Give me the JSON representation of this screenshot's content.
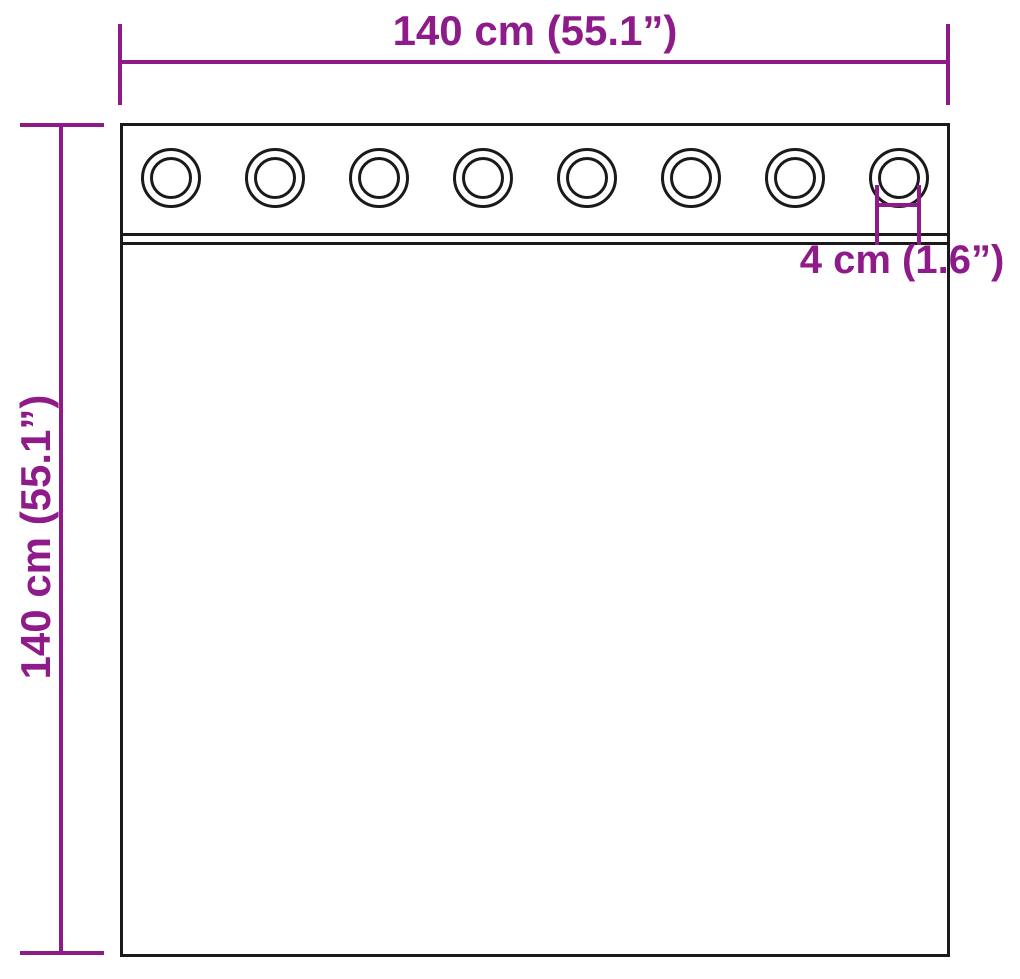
{
  "diagram": {
    "description": "Curtain with grommets dimension diagram",
    "top_dimension": {
      "label": "140 cm (55.1”)"
    },
    "side_dimension": {
      "label": "140 cm (55.1”)"
    },
    "grommet_dimension": {
      "label": "4 cm (1.6”)"
    },
    "grommets": {
      "count": 8
    },
    "colors": {
      "dimension_accent": "#8e1b89",
      "outline": "#1a1a1a",
      "background": "#ffffff"
    }
  }
}
